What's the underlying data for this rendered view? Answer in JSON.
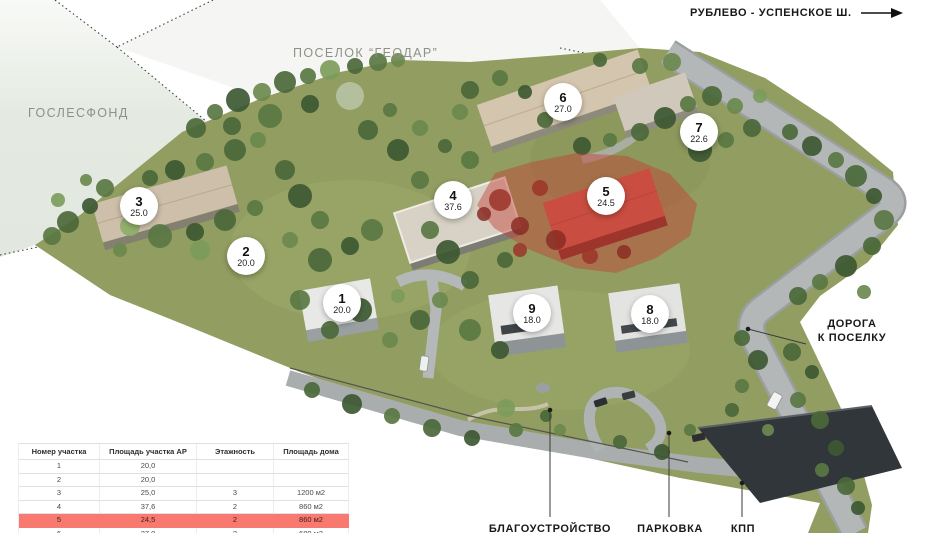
{
  "region_labels": {
    "highway": "РУБЛЕВО - УСПЕНСКОЕ Ш.",
    "settlement": "ПОСЕЛОК “ГЕОДАР”",
    "forest": "ГОСЛЕСФОНД",
    "road_line1": "ДОРОГА",
    "road_line2": "К ПОСЕЛКУ",
    "landscaping": "БЛАГОУСТРОЙСТВО",
    "parking": "ПАРКОВКА",
    "checkpoint": "КПП"
  },
  "plots": [
    {
      "number": "1",
      "area": "20.0"
    },
    {
      "number": "2",
      "area": "20.0"
    },
    {
      "number": "3",
      "area": "25.0"
    },
    {
      "number": "4",
      "area": "37.6"
    },
    {
      "number": "5",
      "area": "24.5"
    },
    {
      "number": "6",
      "area": "27.0"
    },
    {
      "number": "7",
      "area": "22.6"
    },
    {
      "number": "8",
      "area": "18.0"
    },
    {
      "number": "9",
      "area": "18.0"
    }
  ],
  "table": {
    "headers": [
      "Номер участка",
      "Площадь участка АР",
      "Этажность",
      "Площадь дома"
    ],
    "rows": [
      {
        "cells": [
          "1",
          "20,0",
          "",
          ""
        ],
        "highlight": false
      },
      {
        "cells": [
          "2",
          "20,0",
          "",
          ""
        ],
        "highlight": false
      },
      {
        "cells": [
          "3",
          "25,0",
          "3",
          "1200 м2"
        ],
        "highlight": false
      },
      {
        "cells": [
          "4",
          "37,6",
          "2",
          "860 м2"
        ],
        "highlight": false
      },
      {
        "cells": [
          "5",
          "24,5",
          "2",
          "860 м2"
        ],
        "highlight": true
      },
      {
        "cells": [
          "6",
          "27,0",
          "2",
          "680 м2"
        ],
        "highlight": false
      }
    ]
  },
  "colors": {
    "selected_row": "#f8796f",
    "highlighted_plot_zone": "#c43e32",
    "grass": "#919d61",
    "forest_zone": "#e4eae1"
  }
}
